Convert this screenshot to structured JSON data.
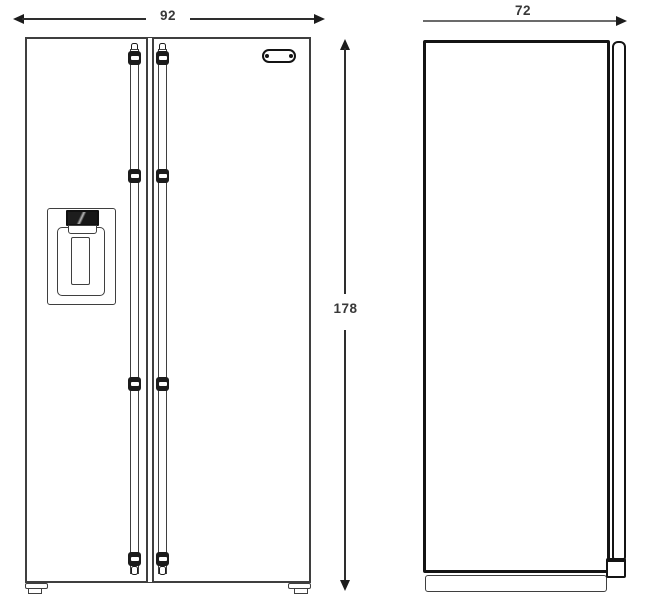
{
  "diagram": {
    "type": "appliance-dimension-drawing",
    "subject": "side-by-side refrigerator, front and side elevation views",
    "dimensions": {
      "front_width": "92",
      "height": "178",
      "side_depth": "72"
    },
    "colors": {
      "background": "#ffffff",
      "light_outline": "#3f3f3f",
      "heavy_outline": "#141414",
      "dimension_line": "#2e2e2e",
      "dimension_line_gray": "#6b6b6b",
      "dimension_text": "#383838"
    }
  }
}
